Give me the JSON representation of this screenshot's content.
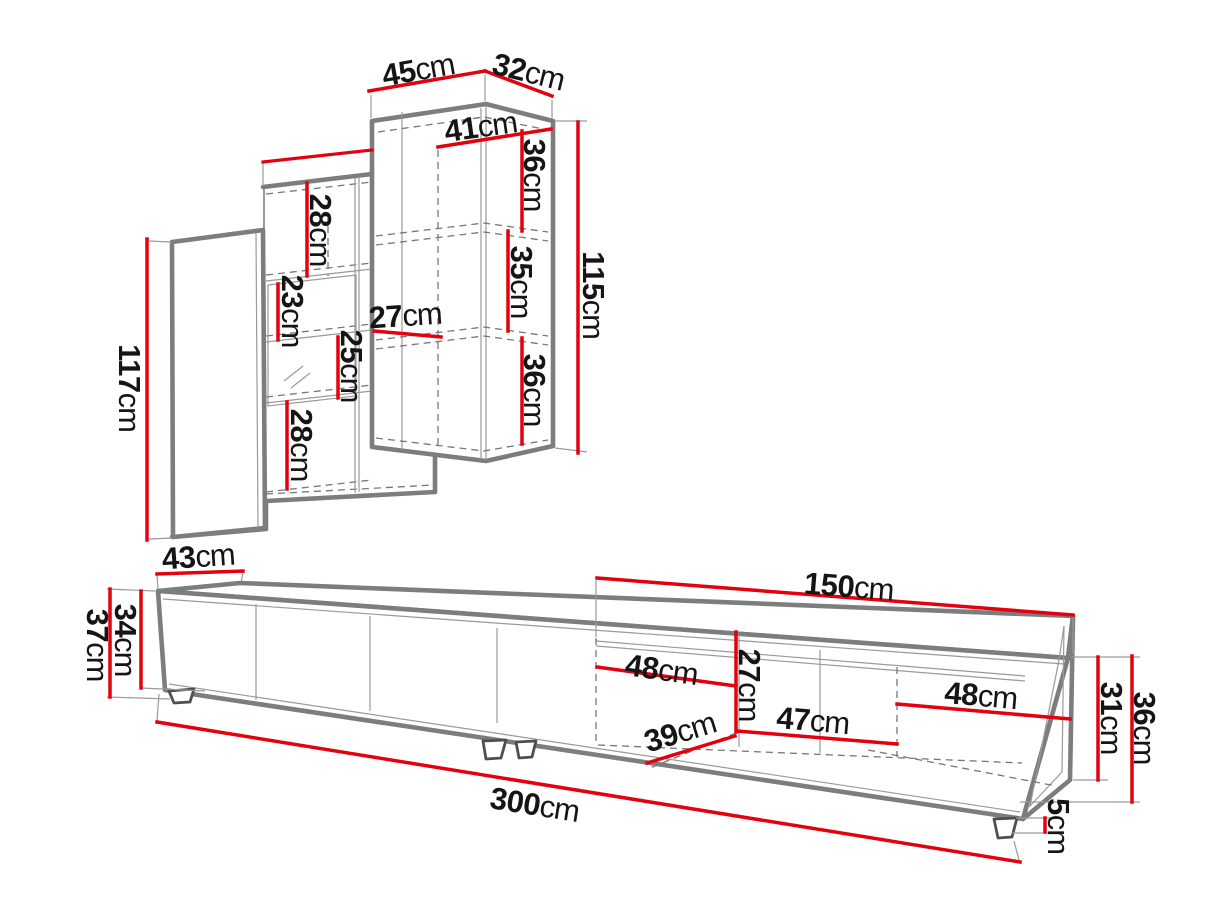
{
  "diagram": {
    "type": "furniture-dimension-drawing",
    "unit": "cm",
    "colors": {
      "dimension_line": "#e3000f",
      "structure": "#7d7d7d",
      "text": "#151515",
      "background": "#ffffff"
    },
    "wall_unit": {
      "label": "wall-cabinet",
      "dims": {
        "top_width": {
          "v": "45",
          "u": "cm"
        },
        "top_depth": {
          "v": "32",
          "u": "cm"
        },
        "inner_width": {
          "v": "41",
          "u": "cm"
        },
        "shelf_top": {
          "v": "36",
          "u": "cm"
        },
        "shelf_middle": {
          "v": "35",
          "u": "cm"
        },
        "shelf_bottom": {
          "v": "36",
          "u": "cm"
        },
        "height_right": {
          "v": "115",
          "u": "cm"
        },
        "height_left": {
          "v": "117",
          "u": "cm"
        },
        "compartment_1": {
          "v": "28",
          "u": "cm"
        },
        "compartment_2": {
          "v": "23",
          "u": "cm"
        },
        "compartment_3": {
          "v": "25",
          "u": "cm"
        },
        "compartment_4": {
          "v": "28",
          "u": "cm"
        },
        "inner_depth": {
          "v": "27",
          "u": "cm"
        }
      }
    },
    "tv_stand": {
      "label": "tv-stand",
      "dims": {
        "depth": {
          "v": "43",
          "u": "cm"
        },
        "height_total": {
          "v": "37",
          "u": "cm"
        },
        "height_body": {
          "v": "34",
          "u": "cm"
        },
        "length_total": {
          "v": "300",
          "u": "cm"
        },
        "right_span": {
          "v": "150",
          "u": "cm"
        },
        "compartment_left": {
          "v": "48",
          "u": "cm"
        },
        "inner_height": {
          "v": "27",
          "u": "cm"
        },
        "compartment_middle": {
          "v": "47",
          "u": "cm"
        },
        "compartment_right": {
          "v": "48",
          "u": "cm"
        },
        "inner_depth": {
          "v": "39",
          "u": "cm"
        },
        "right_inner_height": {
          "v": "31",
          "u": "cm"
        },
        "right_height": {
          "v": "36",
          "u": "cm"
        },
        "leg_height": {
          "v": "5",
          "u": "cm"
        }
      }
    }
  }
}
